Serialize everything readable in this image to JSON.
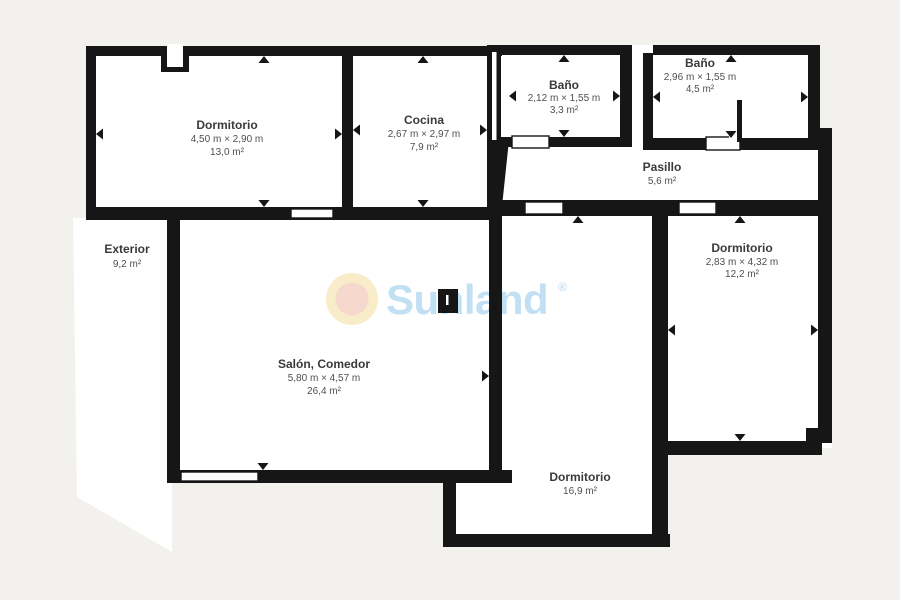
{
  "palette": {
    "background": "#f2f1ee",
    "floor": "#ffffff",
    "wall": "#161616",
    "room_name_color": "#3a3a3a",
    "room_dims_color": "#4f4f4f",
    "watermark_blue": "#c2e0f4",
    "logo_ring_outer": "#f9ecc8",
    "logo_ring_inner": "#f6d9cc"
  },
  "watermark": {
    "text": "Sunland",
    "registered": "®"
  },
  "rooms": [
    {
      "name": "Dormitorio",
      "dimensions": "4,50 m × 2,90 m",
      "area": "13,0 m²"
    },
    {
      "name": "Cocina",
      "dimensions": "2,67 m × 2,97 m",
      "area": "7,9 m²"
    },
    {
      "name": "Baño",
      "dimensions": "2,12 m × 1,55 m",
      "area": "3,3 m²"
    },
    {
      "name": "Baño",
      "dimensions": "2,96 m × 1,55 m",
      "area": "4,5 m²"
    },
    {
      "name": "Pasillo",
      "area": "5,6 m²"
    },
    {
      "name": "Dormitorio",
      "dimensions": "2,83 m × 4,32 m",
      "area": "12,2 m²"
    },
    {
      "name": "Dormitorio",
      "area": "16,9 m²"
    },
    {
      "name": "Salón, Comedor",
      "dimensions": "5,80 m × 4,57 m",
      "area": "26,4 m²"
    },
    {
      "name": "Exterior",
      "area": "9,2 m²"
    }
  ]
}
